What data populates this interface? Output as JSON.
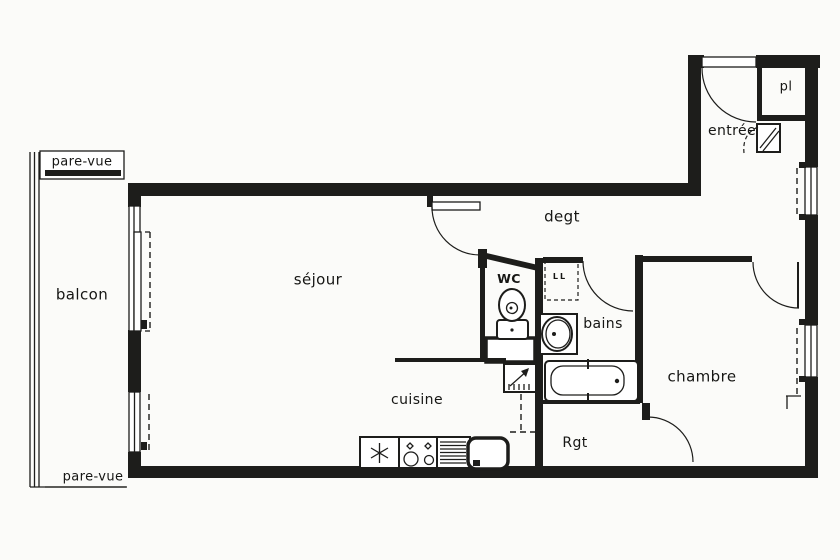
{
  "document": {
    "type": "apartment floor plan",
    "style": "scanned black-and-white drawing"
  },
  "colors": {
    "paper": "#fbfbf9",
    "ink": "#1d1d1b"
  },
  "plan": {
    "labels": {
      "balcon": "balcon",
      "pare_vue_top": "pare-vue",
      "pare_vue_bottom": "pare-vue",
      "sejour": "séjour",
      "degt": "degt",
      "wc": "WC",
      "ll": "LL",
      "bains": "bains",
      "chambre": "chambre",
      "cuisine": "cuisine",
      "rgt": "Rgt",
      "entree": "entrée",
      "pl": "pl"
    },
    "rooms": [
      "balcon",
      "séjour",
      "degt",
      "WC",
      "bains",
      "chambre",
      "cuisine",
      "Rgt",
      "entrée",
      "pl"
    ],
    "fixtures": [
      "entry-door",
      "placard-closet",
      "technical-closet",
      "toilet",
      "washbasin",
      "bathtub",
      "washing-machine-slot",
      "water-heater",
      "fridge",
      "stove",
      "drainboard",
      "kitchen-sink",
      "balcony-sliding-door",
      "balcony-window",
      "window-right-upper",
      "window-right-lower",
      "privacy-screen-top",
      "privacy-screen-bottom"
    ]
  }
}
